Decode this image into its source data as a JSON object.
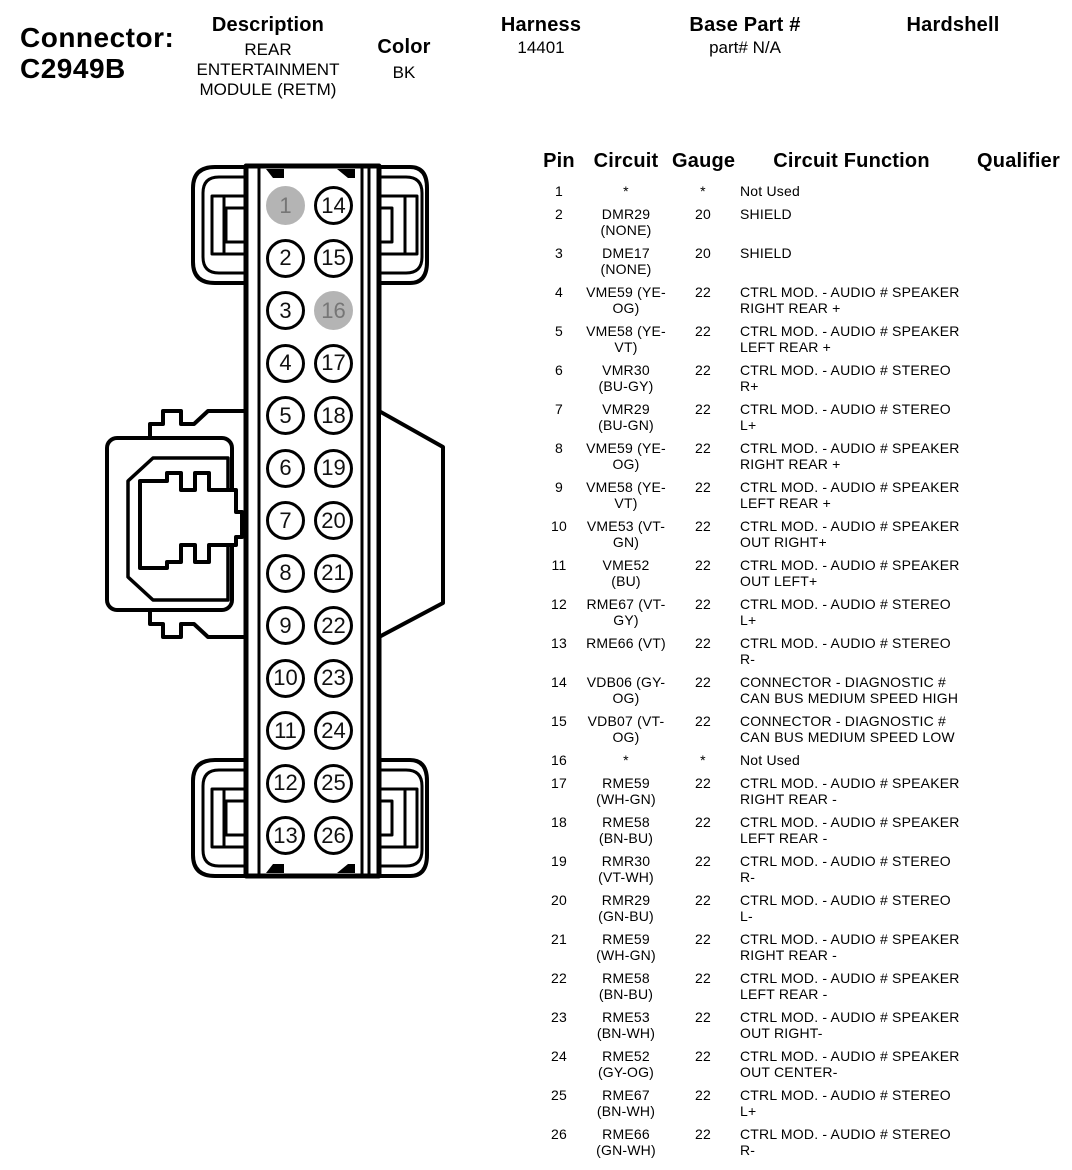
{
  "page_header": {
    "connector_label": "Connector:",
    "connector_id": "C2949B",
    "description_label": "Description",
    "description_value": "REAR\nENTERTAINMENT\nMODULE (RETM)",
    "color_label": "Color",
    "color_value": "BK",
    "harness_label": "Harness",
    "harness_value": "14401",
    "base_part_label": "Base Part #",
    "base_part_value": "part# N/A",
    "hardshell_label": "Hardshell",
    "hardshell_value": ""
  },
  "connector_diagram": {
    "line_color": "#000000",
    "unused_pin_fill": "#b4b4b4",
    "left_pins": [
      {
        "number": "1",
        "state": "unused"
      },
      {
        "number": "2",
        "state": "used"
      },
      {
        "number": "3",
        "state": "used"
      },
      {
        "number": "4",
        "state": "used"
      },
      {
        "number": "5",
        "state": "used"
      },
      {
        "number": "6",
        "state": "used"
      },
      {
        "number": "7",
        "state": "used"
      },
      {
        "number": "8",
        "state": "used"
      },
      {
        "number": "9",
        "state": "used"
      },
      {
        "number": "10",
        "state": "used"
      },
      {
        "number": "11",
        "state": "used"
      },
      {
        "number": "12",
        "state": "used"
      },
      {
        "number": "13",
        "state": "used"
      }
    ],
    "right_pins": [
      {
        "number": "14",
        "state": "used"
      },
      {
        "number": "15",
        "state": "used"
      },
      {
        "number": "16",
        "state": "unused"
      },
      {
        "number": "17",
        "state": "used"
      },
      {
        "number": "18",
        "state": "used"
      },
      {
        "number": "19",
        "state": "used"
      },
      {
        "number": "20",
        "state": "used"
      },
      {
        "number": "21",
        "state": "used"
      },
      {
        "number": "22",
        "state": "used"
      },
      {
        "number": "23",
        "state": "used"
      },
      {
        "number": "24",
        "state": "used"
      },
      {
        "number": "25",
        "state": "used"
      },
      {
        "number": "26",
        "state": "used"
      }
    ]
  },
  "pin_table": {
    "headers": {
      "pin": "Pin",
      "circuit": "Circuit",
      "gauge": "Gauge",
      "function": "Circuit Function",
      "qualifier": "Qualifier"
    },
    "rows": [
      {
        "pin": "1",
        "circuit": "*",
        "gauge": "*",
        "function": "Not Used",
        "qualifier": ""
      },
      {
        "pin": "2",
        "circuit": "DMR29\n(NONE)",
        "gauge": "20",
        "function": "SHIELD",
        "qualifier": ""
      },
      {
        "pin": "3",
        "circuit": "DME17\n(NONE)",
        "gauge": "20",
        "function": "SHIELD",
        "qualifier": ""
      },
      {
        "pin": "4",
        "circuit": "VME59 (YE-\nOG)",
        "gauge": "22",
        "function": "CTRL MOD. - AUDIO # SPEAKER\nRIGHT REAR +",
        "qualifier": ""
      },
      {
        "pin": "5",
        "circuit": "VME58 (YE-\nVT)",
        "gauge": "22",
        "function": "CTRL MOD. - AUDIO # SPEAKER\nLEFT REAR +",
        "qualifier": ""
      },
      {
        "pin": "6",
        "circuit": "VMR30\n(BU-GY)",
        "gauge": "22",
        "function": "CTRL MOD. - AUDIO # STEREO\nR+",
        "qualifier": ""
      },
      {
        "pin": "7",
        "circuit": "VMR29\n(BU-GN)",
        "gauge": "22",
        "function": "CTRL MOD. - AUDIO # STEREO\nL+",
        "qualifier": ""
      },
      {
        "pin": "8",
        "circuit": "VME59 (YE-\nOG)",
        "gauge": "22",
        "function": "CTRL MOD. - AUDIO # SPEAKER\nRIGHT REAR +",
        "qualifier": ""
      },
      {
        "pin": "9",
        "circuit": "VME58 (YE-\nVT)",
        "gauge": "22",
        "function": "CTRL MOD. - AUDIO # SPEAKER\nLEFT REAR +",
        "qualifier": ""
      },
      {
        "pin": "10",
        "circuit": "VME53 (VT-\nGN)",
        "gauge": "22",
        "function": "CTRL MOD. - AUDIO # SPEAKER\nOUT RIGHT+",
        "qualifier": ""
      },
      {
        "pin": "11",
        "circuit": "VME52\n(BU)",
        "gauge": "22",
        "function": "CTRL MOD. - AUDIO # SPEAKER\nOUT LEFT+",
        "qualifier": ""
      },
      {
        "pin": "12",
        "circuit": "RME67 (VT-\nGY)",
        "gauge": "22",
        "function": "CTRL MOD. - AUDIO # STEREO\nL+",
        "qualifier": ""
      },
      {
        "pin": "13",
        "circuit": "RME66 (VT)",
        "gauge": "22",
        "function": "CTRL MOD. - AUDIO # STEREO\nR-",
        "qualifier": ""
      },
      {
        "pin": "14",
        "circuit": "VDB06 (GY-\nOG)",
        "gauge": "22",
        "function": "CONNECTOR - DIAGNOSTIC #\nCAN BUS MEDIUM SPEED HIGH",
        "qualifier": ""
      },
      {
        "pin": "15",
        "circuit": "VDB07 (VT-\nOG)",
        "gauge": "22",
        "function": "CONNECTOR - DIAGNOSTIC #\nCAN BUS MEDIUM SPEED LOW",
        "qualifier": ""
      },
      {
        "pin": "16",
        "circuit": "*",
        "gauge": "*",
        "function": "Not Used",
        "qualifier": ""
      },
      {
        "pin": "17",
        "circuit": "RME59\n(WH-GN)",
        "gauge": "22",
        "function": "CTRL MOD. - AUDIO # SPEAKER\nRIGHT REAR -",
        "qualifier": ""
      },
      {
        "pin": "18",
        "circuit": "RME58\n(BN-BU)",
        "gauge": "22",
        "function": "CTRL MOD. - AUDIO # SPEAKER\nLEFT REAR -",
        "qualifier": ""
      },
      {
        "pin": "19",
        "circuit": "RMR30\n(VT-WH)",
        "gauge": "22",
        "function": "CTRL MOD. - AUDIO # STEREO\nR-",
        "qualifier": ""
      },
      {
        "pin": "20",
        "circuit": "RMR29\n(GN-BU)",
        "gauge": "22",
        "function": "CTRL MOD. - AUDIO # STEREO\nL-",
        "qualifier": ""
      },
      {
        "pin": "21",
        "circuit": "RME59\n(WH-GN)",
        "gauge": "22",
        "function": "CTRL MOD. - AUDIO # SPEAKER\nRIGHT REAR -",
        "qualifier": ""
      },
      {
        "pin": "22",
        "circuit": "RME58\n(BN-BU)",
        "gauge": "22",
        "function": "CTRL MOD. - AUDIO # SPEAKER\nLEFT REAR -",
        "qualifier": ""
      },
      {
        "pin": "23",
        "circuit": "RME53\n(BN-WH)",
        "gauge": "22",
        "function": "CTRL MOD. - AUDIO # SPEAKER\nOUT RIGHT-",
        "qualifier": ""
      },
      {
        "pin": "24",
        "circuit": "RME52\n(GY-OG)",
        "gauge": "22",
        "function": "CTRL MOD. - AUDIO # SPEAKER\nOUT CENTER-",
        "qualifier": ""
      },
      {
        "pin": "25",
        "circuit": "RME67\n(BN-WH)",
        "gauge": "22",
        "function": "CTRL MOD. - AUDIO # STEREO\nL+",
        "qualifier": ""
      },
      {
        "pin": "26",
        "circuit": "RME66\n(GN-WH)",
        "gauge": "22",
        "function": "CTRL MOD. - AUDIO # STEREO\nR-",
        "qualifier": ""
      }
    ]
  }
}
